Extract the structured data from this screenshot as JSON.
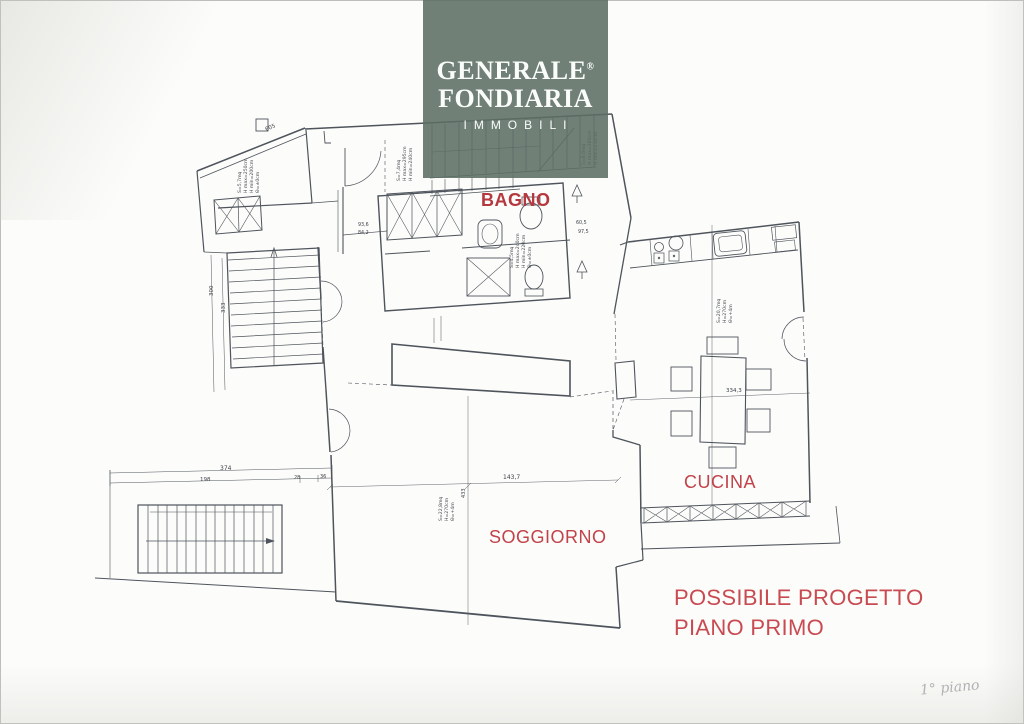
{
  "logo": {
    "line1": "GENERALE",
    "registered": "®",
    "line2": "FONDIARIA",
    "line3": "IMMOBILI",
    "bg_color": "#6f8076",
    "text_color": "#fbfdfb"
  },
  "rooms": {
    "bagno": "BAGNO",
    "cucina": "CUCINA",
    "soggiorno": "SOGGIORNO"
  },
  "project_note": {
    "line1": "POSSIBILE PROGETTO",
    "line2": "PIANO PRIMO"
  },
  "handwriting": "1° piano",
  "colors": {
    "label_red": "#c2424a",
    "plan_line": "#4e545c"
  },
  "dims": {
    "d605": "605",
    "d374": "374",
    "d198": "198",
    "d28": "28",
    "d36": "36",
    "d300": "300",
    "d333": "333",
    "d1437": "143,7",
    "d433": "433",
    "d3343": "334,3",
    "d936": "93,6",
    "d842": "84,2",
    "d605b": "60,5",
    "d975": "97,5"
  },
  "specs": {
    "room_a": [
      "S=5,7mq",
      "H max=250cm",
      "H min=200cm",
      "Θ=±0cm"
    ],
    "hall_1": [
      "S=7,4mq",
      "H max=295cm",
      "H min=240cm"
    ],
    "hall_2": [
      "S=8,6mq",
      "H max=280cm",
      "H min=230cm"
    ],
    "bagno": [
      "S=4,5mq",
      "H max=240cm",
      "H min=220cm",
      "Θ=±0cm"
    ],
    "cucina": [
      "S=20,7mq",
      "H=270cm",
      "Θ=+4m"
    ],
    "soggiorno": [
      "S=22,8mq",
      "H=270cm",
      "Θ=+4m"
    ]
  }
}
